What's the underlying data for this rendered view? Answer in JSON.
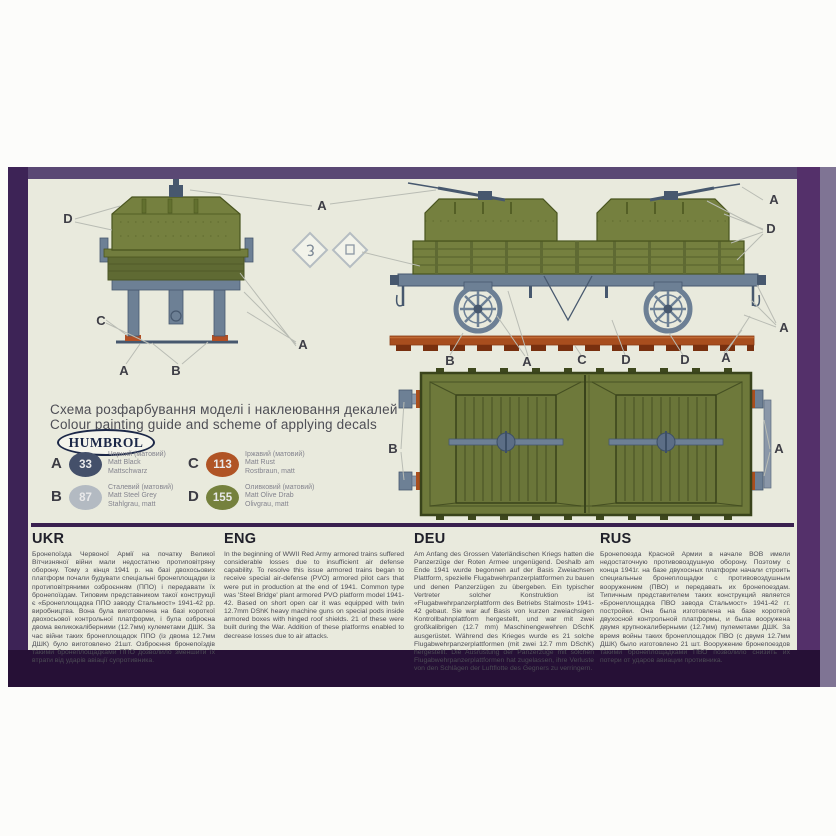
{
  "brand": {
    "name": "HUMBROL"
  },
  "guide": {
    "title_line1": "Схема розфарбування моделі і наклеювання декалей",
    "title_line2": "Colour painting guide and scheme of applying decals"
  },
  "paints": {
    "items": [
      {
        "key": "A",
        "code": "33",
        "color": "#44506a",
        "lines": [
          "Чорний (матовий)",
          "Matt Black",
          "Mattschwarz"
        ]
      },
      {
        "key": "B",
        "code": "87",
        "color": "#b3bac2",
        "lines": [
          "Сталевий (матовий)",
          "Matt Steel Grey",
          "Stahlgrau, matt"
        ]
      },
      {
        "key": "C",
        "code": "113",
        "color": "#b05425",
        "lines": [
          "Іржавий (матовий)",
          "Matt Rust",
          "Rostbraun, matt"
        ]
      },
      {
        "key": "D",
        "code": "155",
        "color": "#75813d",
        "lines": [
          "Оливковий (матовий)",
          "Matt Olive Drab",
          "Olivgrau, matt"
        ]
      }
    ]
  },
  "diagram": {
    "labels": [
      "D",
      "A",
      "C",
      "A",
      "B",
      "A",
      "A",
      "D",
      "A",
      "B",
      "A",
      "C",
      "D",
      "D",
      "A",
      "B",
      "A"
    ]
  },
  "columns": [
    {
      "title": "UKR",
      "body": "Бронепоїзда Червоної Армії на початку Великої Вітчизняної війни мали недостатню протиповітряну оборону. Тому з кінця 1941 р. на базі двохосьових платформ почали будувати спеціальні бронеплощадки із протиповітряними озброєнням (ППО) і передавати їх бронепоїздам. Типовим представником такої конструкції є «Бронеплощадка ППО заводу Стальмост» 1941-42 рр. виробництва. Вона була виготовлена на базі короткої двохосьової контрольної платформи, і була озброєна двома великокаліберними (12.7мм) кулеметами ДШК. За час війни таких бронеплощадок ППО (із двома 12.7мм ДШК) було виготовлено 21шт. Озброєння бронепоїздів такими бронеплощадками ППО дозволило зменшити їх втрати від ударів авіації супротивника."
    },
    {
      "title": "ENG",
      "body": "In the beginning of WWII Red Army armored trains suffered considerable losses due to insufficient air defense capability. To resolve this issue armored trains began to receive special air-defense (PVO) armored pilot cars that were put in production at the end of 1941. Common type was 'Steel Bridge' plant armored PVO platform model 1941-42. Based on short open car it was equipped with twin 12.7mm DShK heavy machine guns on special pods inside armored boxes with hinged roof shields. 21 of these were built during the War. Addition of these platforms enabled to decrease losses due to air attacks."
    },
    {
      "title": "DEU",
      "body": "Am Anfang des Grossen Vaterländischen Kriegs hatten die Panzerzüge der Roten Armee ungenügend. Deshalb am Ende 1941 wurde begonnen auf der Basis Zweiachsen Plattform, spezielle Flugabwehrpanzerplattformen zu bauen und denen Panzerzügen zu übergeben. Ein typischer Vertreter solcher Konstruktion ist «Flugabwehrpanzerplattform des Betriebs Stalmost» 1941-42 gebaut. Sie war auf Basis von kurzen zweiachsigen Kontrollbahnplattform hergestellt, und war mit zwei großkalibrigen (12.7 mm) Maschinengewehren DSchK ausgerüstet. Während des Krieges wurde es 21 solche Flugabwehrpanzerplattformen (mit zwei 12.7 mm DSchK) hergestellt. Die Ausrüstung der Panzerzüge mit solchen Flugabwehrpanzerplattformen hat zugelassen, ihre Verluste von den Schlägen der Luftflotte des Gegners zu verringern."
    },
    {
      "title": "RUS",
      "body": "Бронепоезда Красной Армии в начале ВОВ имели недостаточную противовоздушную оборону. Поэтому с конца 1941г. на базе двухосных платформ начали строить специальные бронеплощадки с противовоздушным вооружением (ПВО) и передавать их бронепоездам. Типичным представителем таких конструкций является «Бронеплощадка ПВО завода Стальмост» 1941-42 гг. постройки. Она была изготовлена на базе короткой двухосной контрольной платформы, и была вооружена двумя крупнокалиберными (12.7мм) пулеметами ДШК. За время войны таких бронеплощадок ПВО (с двумя 12.7мм ДШК) было изготовлено 21 шт. Вооружение бронепоездов такими бронеплощадками ПВО позволило снизить их потери от ударов авиации противника."
    }
  ],
  "colors": {
    "frame_purple": "#3d2356",
    "frame_bottom": "#261036",
    "panel_background": "#e9eadd",
    "armor_olive": "#75803f",
    "chassis_steel": "#6d8095",
    "rust_rail": "#a84e1e"
  }
}
